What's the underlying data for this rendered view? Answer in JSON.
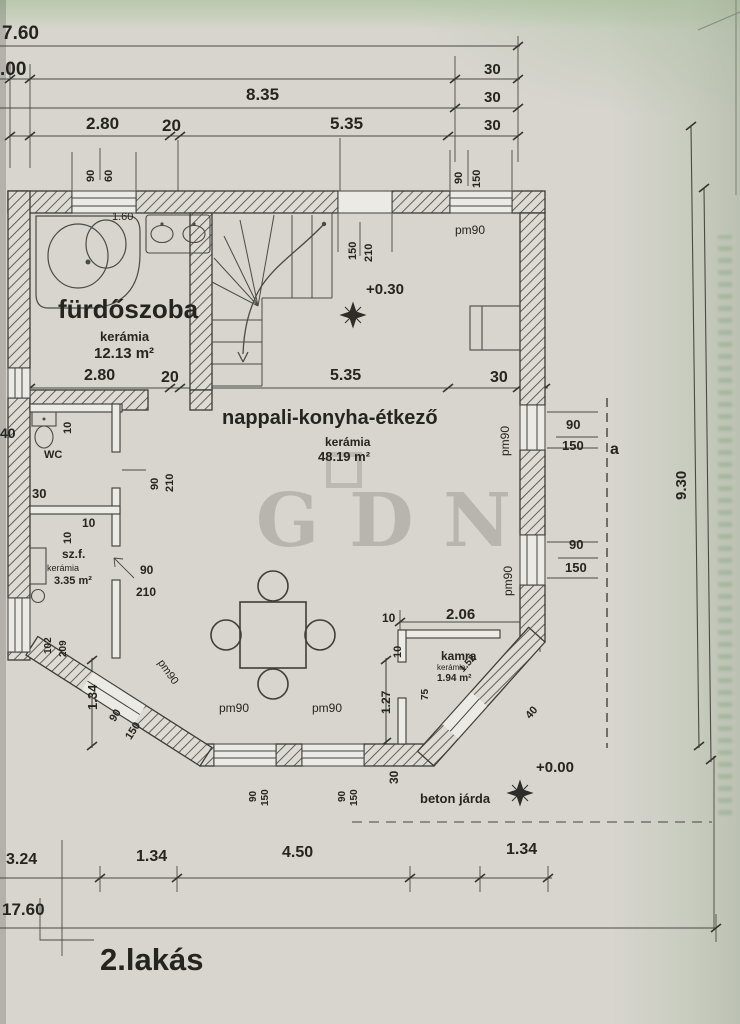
{
  "title": "2.lakás",
  "watermark": "GDN",
  "top_dims": {
    "total": "7.60",
    "second": ".00",
    "d835": "8.35",
    "d280": "2.80",
    "d20": "20",
    "d535": "5.35"
  },
  "inner_dims": {
    "d280": "2.80",
    "d20": "20",
    "d535": "5.35",
    "d30": "30"
  },
  "bottom_dims": {
    "d324": "3.24",
    "d134a": "1.34",
    "d450": "4.50",
    "d134b": "1.34",
    "total": "17.60"
  },
  "right_dims": {
    "d930": "9.30",
    "section_label": "a"
  },
  "levels": {
    "upper": "+0.30",
    "ground": "+0.00",
    "walkway_label": "beton járda"
  },
  "rooms": {
    "bathroom": {
      "name": "fürdőszoba",
      "material": "kerámia",
      "area": "12.13 m²",
      "fixture_dim": "1.60"
    },
    "living": {
      "name": "nappali-konyha-étkező",
      "material": "kerámia",
      "area": "48.19 m²"
    },
    "wc": {
      "name": "WC"
    },
    "szf": {
      "name": "sz.f.",
      "material": "kerámia",
      "area": "3.35 m²"
    },
    "kamra": {
      "name": "kamra",
      "material": "kerámia",
      "area": "1.94 m²"
    }
  },
  "tags": {
    "n10": "10",
    "n30": "30",
    "n40": "40",
    "n60": "60",
    "n75": "75",
    "n90": "90",
    "n102": "102",
    "n127": "1.27",
    "n134": "1.34",
    "n150": "150",
    "n152": "1.52",
    "n206": "2.06",
    "n209": "209",
    "n210": "210",
    "pm90": "pm90"
  },
  "colors": {
    "paper": "#d8d5cf",
    "ink": "#3b3b37",
    "stamp_green": "#648f5f"
  }
}
